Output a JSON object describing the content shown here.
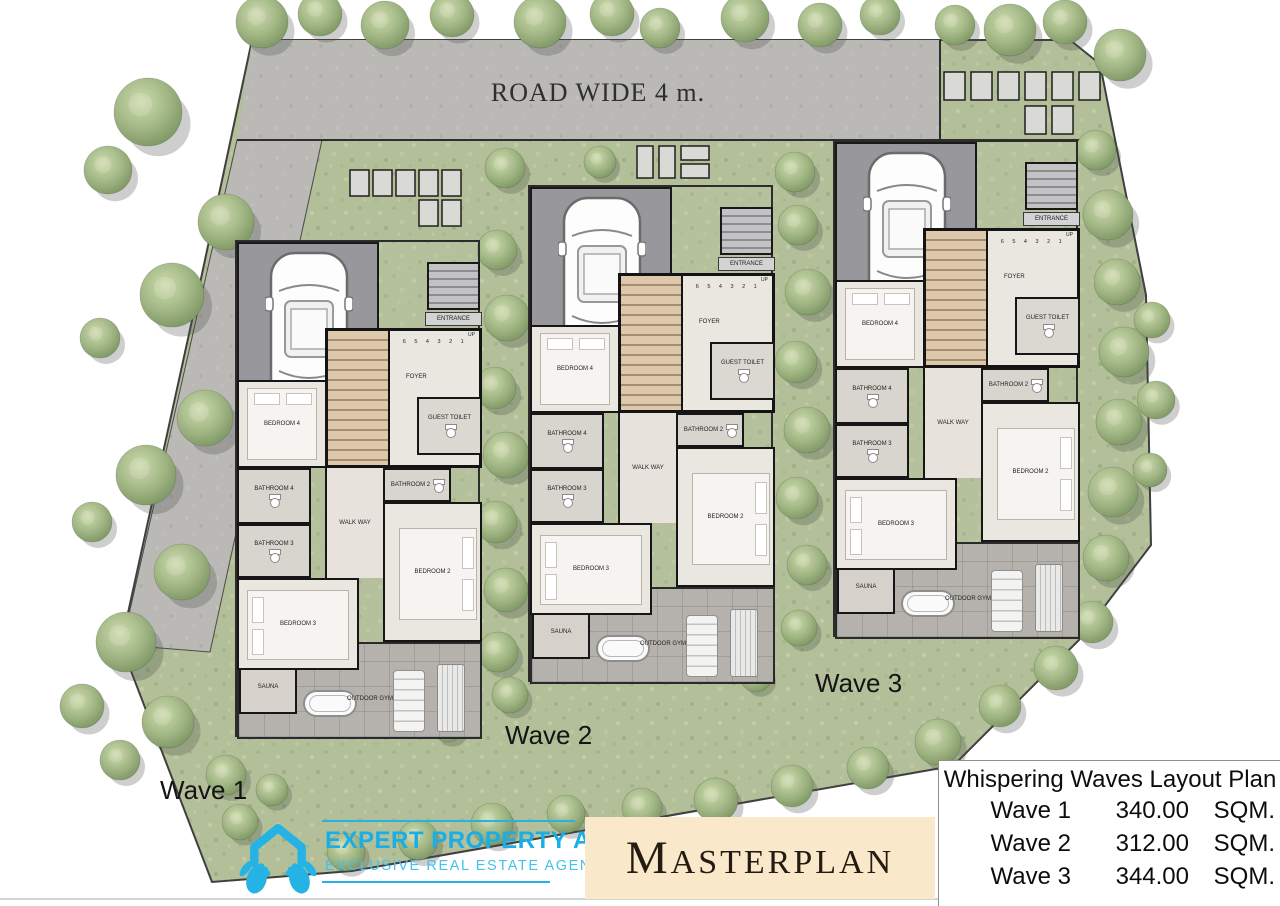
{
  "site": {
    "road_label": "ROAD WIDE 4 m.",
    "colors": {
      "grass": "#b2bf99",
      "road": "#bab9b6",
      "wall": "#161616",
      "floor": "#eae6e0",
      "stairs": "#ddc8ac",
      "terrace": "#b5b2ad",
      "accent_cyan": "#25b3e5",
      "masterplan_beige": "#f9e8ca"
    }
  },
  "houses": [
    {
      "label": "Wave 1"
    },
    {
      "label": "Wave 2"
    },
    {
      "label": "Wave 3"
    }
  ],
  "rooms": {
    "entrance": "ENTRANCE",
    "up": "UP",
    "stair_numbers": "6 5 4 3 2 1",
    "foyer": "FOYER",
    "bedroom4": "BEDROOM 4",
    "guest_toilet": "GUEST TOILET",
    "bathroom2": "BATHROOM 2",
    "bathroom4": "BATHROOM 4",
    "bathroom3": "BATHROOM 3",
    "walkway": "WALK WAY",
    "bedroom2": "BEDROOM 2",
    "bedroom3": "BEDROOM 3",
    "sauna": "SAUNA",
    "outdoor_gym": "OUTDOOR GYM"
  },
  "footer": {
    "brand_name": "EXPERT PROPERTY ASIA",
    "brand_tagline": "EXCLUSIVE REAL ESTATE AGENCY",
    "masterplan_title": "MASTERPLAN"
  },
  "legend": {
    "title": "Whispering Waves Layout Plan",
    "rows": [
      {
        "name": "Wave 1",
        "area": "340.00",
        "unit": "SQM."
      },
      {
        "name": "Wave 2",
        "area": "312.00",
        "unit": "SQM."
      },
      {
        "name": "Wave 3",
        "area": "344.00",
        "unit": "SQM."
      }
    ]
  }
}
